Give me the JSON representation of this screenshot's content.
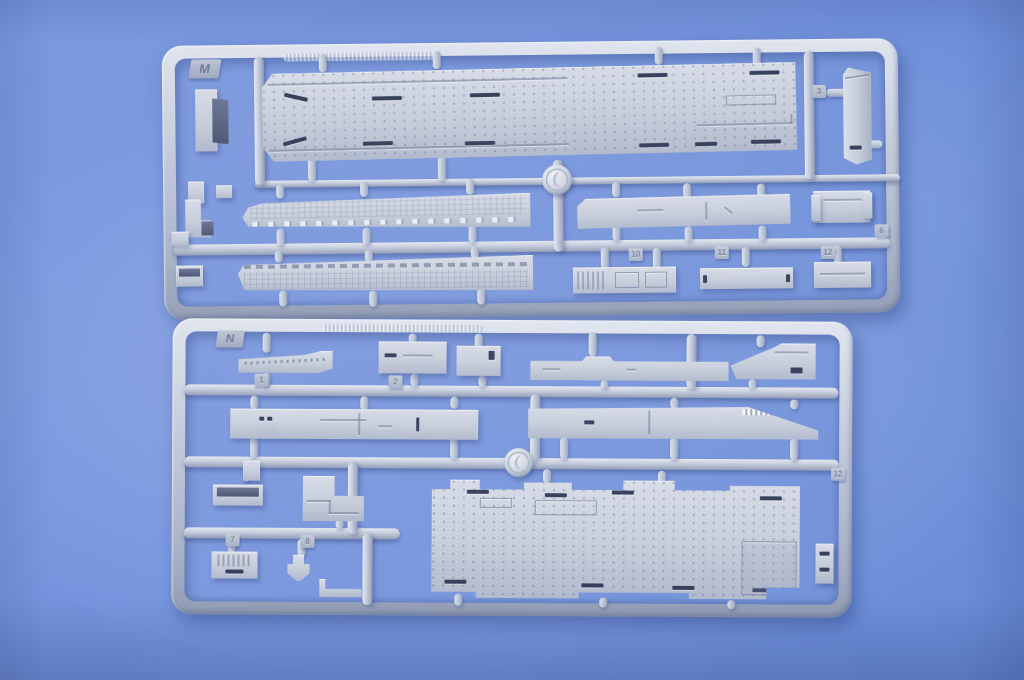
{
  "scene": {
    "description": "Photograph of two light-gray injection-molded plastic model-kit sprues (runners M and N) holding warship deck, hull-side and superstructure parts, lying on a blue leather-textured surface",
    "background_color": "#7392dc",
    "plastic_color": "#c6cdda",
    "detail_slot_color": "#343e5a",
    "shadow_color": "#2d3f70"
  },
  "sprues": [
    {
      "id": "sprue-m",
      "label": "M",
      "tabs": [
        "3",
        "6",
        "10",
        "11",
        "12"
      ],
      "logo": "circular-brand-medallion",
      "parts": [
        "flight-deck-section",
        "end-block",
        "angle-bracket",
        "small-fittings",
        "hull-side-upper",
        "hull-side-lower",
        "deck-strip",
        "mount-bracket",
        "vent-box",
        "slotted-strip",
        "grooved-box"
      ]
    },
    {
      "id": "sprue-n",
      "label": "N",
      "tabs": [
        "1",
        "2",
        "7",
        "8",
        "12"
      ],
      "logo": "circular-brand-medallion",
      "parts": [
        "walkway-strip",
        "deck-plate",
        "small-plate",
        "long-flat-strip",
        "funnel-wedge",
        "superstructure-strip-left",
        "superstructure-strip-right",
        "small-bracket",
        "open-tray",
        "l-platform",
        "ribbed-bracket",
        "t-clip",
        "angle-strip",
        "hangar-deck-panel",
        "small-block"
      ]
    }
  ]
}
